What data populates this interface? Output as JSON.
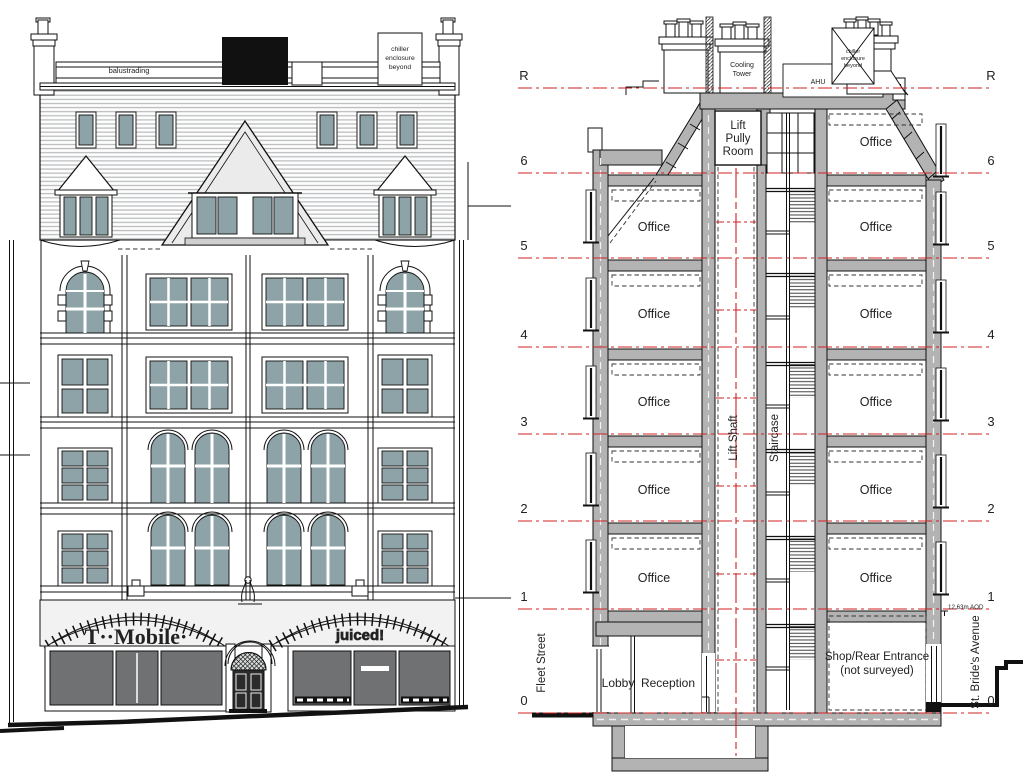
{
  "title": "Building front elevation and cross-section drawing",
  "colors": {
    "poche_gray": "#b3b3b3",
    "window_glazing": "#8da3a7",
    "shop_glazing": "#6f7172",
    "level_line_red": "#d01f1f",
    "plant_box_black": "#111111"
  },
  "elevation": {
    "balustrading": "balustrading",
    "chiller_note": [
      "chiller",
      "enclosure",
      "beyond"
    ],
    "sign_left": "T··Mobile·",
    "sign_right": "juiced!"
  },
  "section": {
    "levels": [
      "R",
      "6",
      "5",
      "4",
      "3",
      "2",
      "1",
      "0"
    ],
    "office": "Office",
    "lift_pully_room": [
      "Lift",
      "Pully",
      "Room"
    ],
    "cooling_tower": [
      "Cooling",
      "Tower"
    ],
    "ahu": "AHU",
    "rooftop_note": [
      "chiller",
      "enclosure",
      "beyond"
    ],
    "lift_shaft": "Lift Shaft",
    "staircase": "Staircase",
    "lobby": "Lobby",
    "reception": "Reception",
    "shop_rear_entrance": [
      "Shop/Rear Entrance",
      "(not surveyed)"
    ],
    "fleet_street": "Fleet Street",
    "st_brides_avenue": "St. Bride's Avenue",
    "datum": "12.63m AOD"
  }
}
